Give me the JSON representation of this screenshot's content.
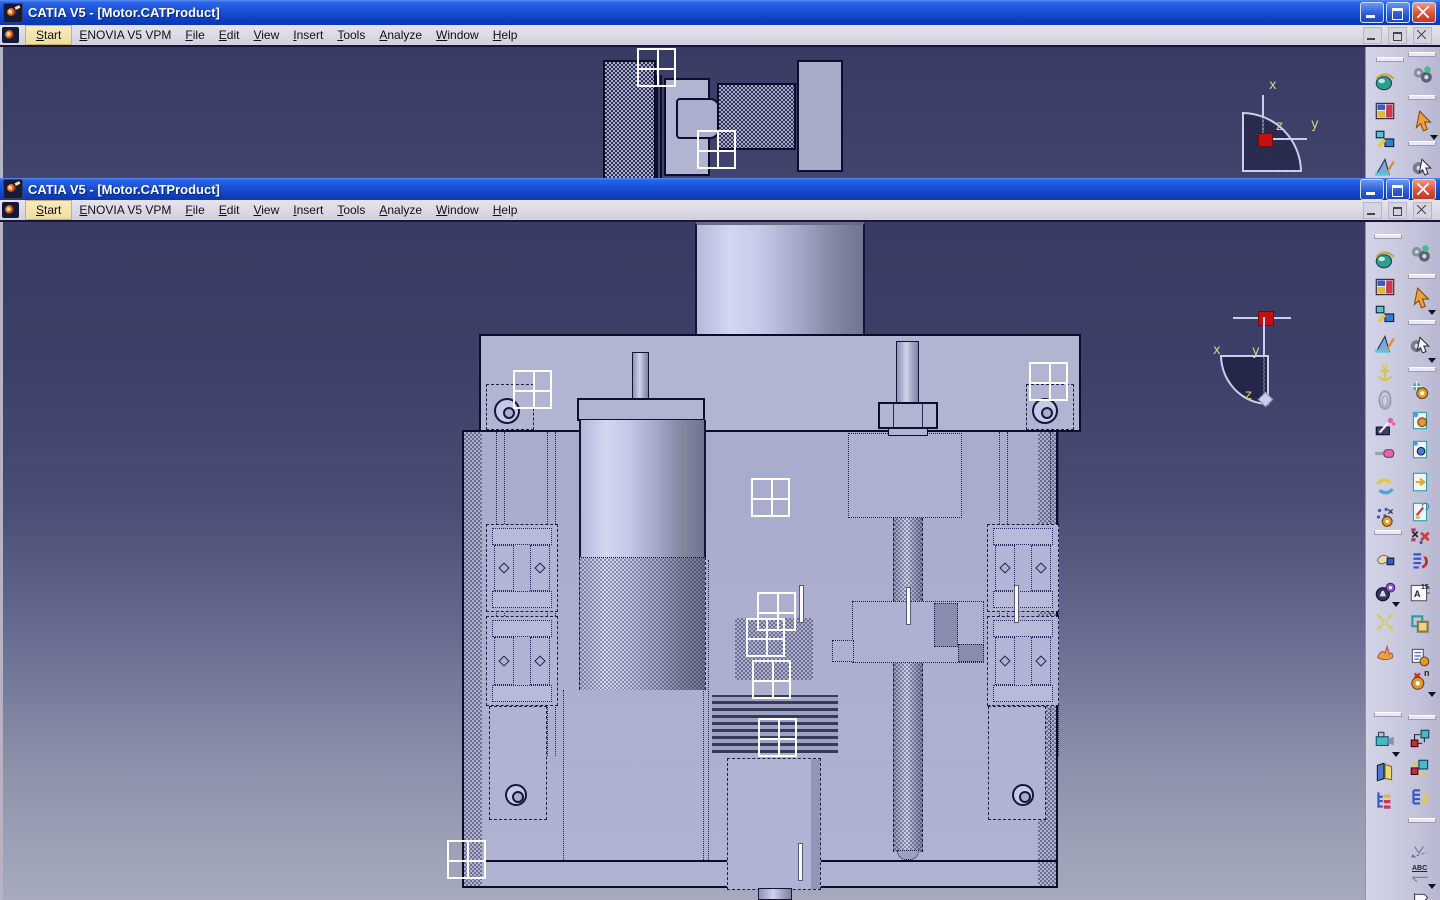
{
  "app": {
    "title": "CATIA V5 - [Motor.CATProduct]"
  },
  "menu": {
    "items": [
      "Start",
      "ENOVIA V5 VPM",
      "File",
      "Edit",
      "View",
      "Insert",
      "Tools",
      "Analyze",
      "Window",
      "Help"
    ]
  },
  "compass": {
    "x": "x",
    "y": "y",
    "z": "z"
  },
  "toolbar": {
    "abc_label": "ABC",
    "numbering_letter": "A",
    "numbering_number": "15",
    "gear_n_label": "n"
  },
  "colors": {
    "titlebar_blue": "#1750d6",
    "viewport_top": "#383b63",
    "viewport_bottom": "#a6aabc",
    "model_lavender": "#b2b5d1",
    "toolbar_bg": "#c9c9df",
    "select_orange": "#f0a038",
    "compass_red": "#c41010",
    "axis_label": "#dccf82"
  }
}
